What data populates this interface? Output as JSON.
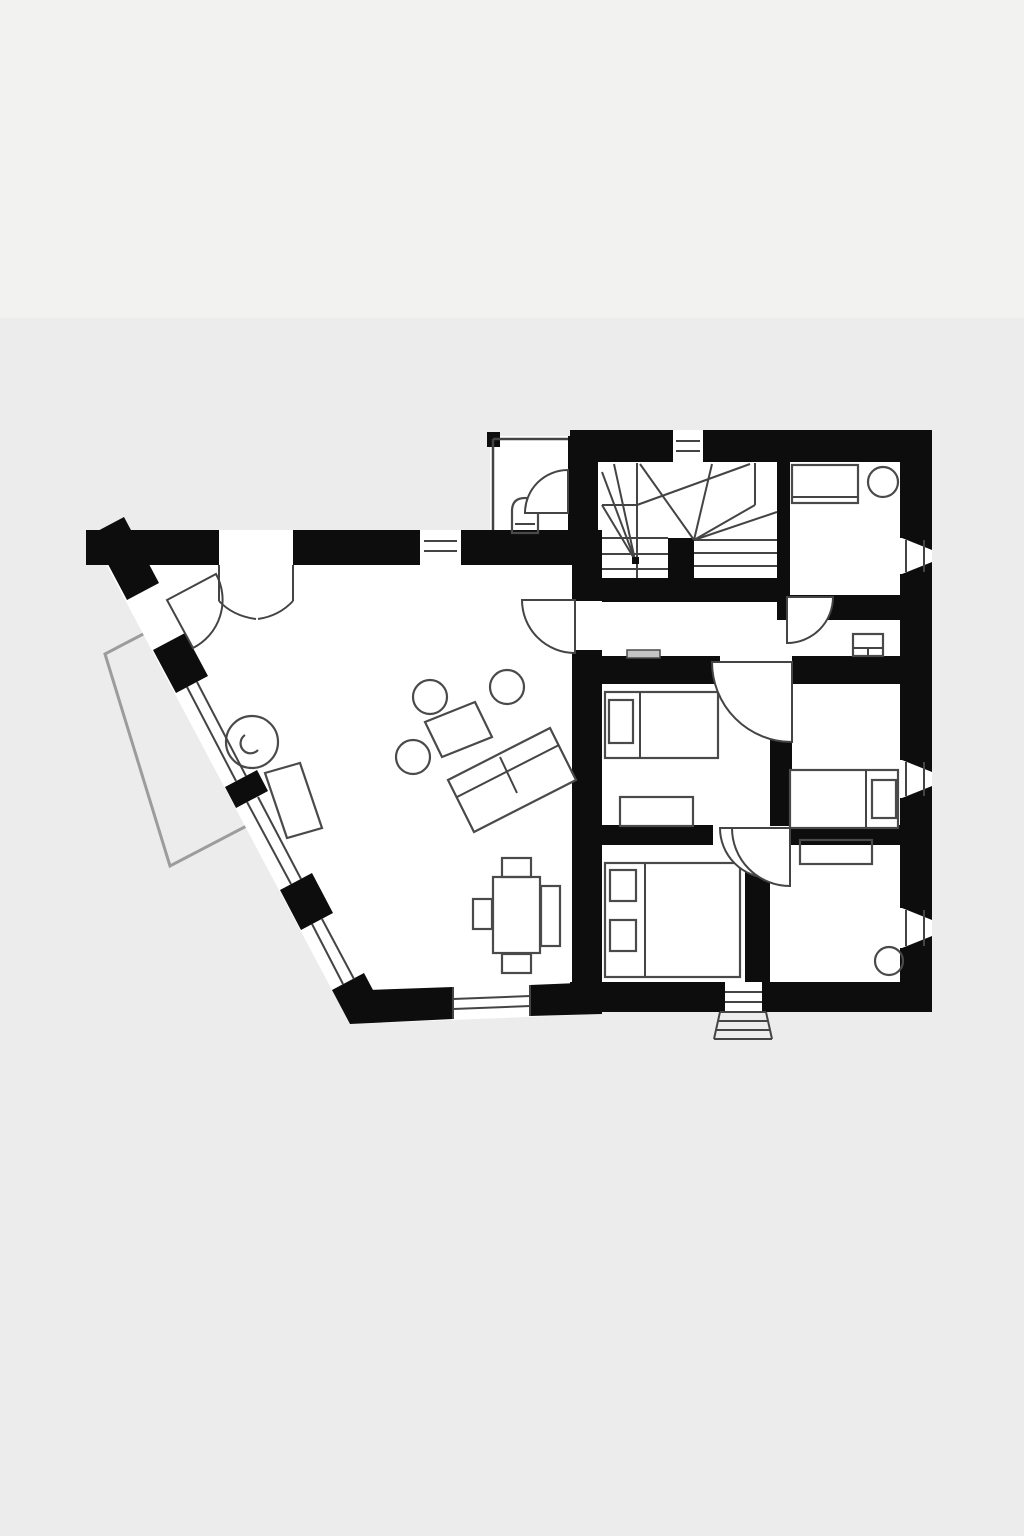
{
  "canvas": {
    "width": 1024,
    "height": 1536
  },
  "colors": {
    "background": "#ececec",
    "background_top": "#f2f2f1",
    "wall": "#0d0d0d",
    "line": "#444444",
    "floor": "#ffffff",
    "furniture": "#4a4a4a",
    "terrace": "#9c9c9c"
  },
  "plan": {
    "type": "apartment-floor-plan",
    "style": "black-and-white architectural drawing, no text labels",
    "rooms": [
      {
        "name": "living-room",
        "shape": "trapezoid with angled west wall"
      },
      {
        "name": "wc-vestibule",
        "feature": "toilet"
      },
      {
        "name": "stair-hall",
        "feature": "winder-staircase with newel post"
      },
      {
        "name": "top-right-room",
        "features": [
          "counter",
          "round-table"
        ]
      },
      {
        "name": "hallway",
        "features": [
          "door-arcs",
          "radiators"
        ]
      },
      {
        "name": "bedroom-middle-left",
        "features": [
          "single-bed",
          "desk"
        ]
      },
      {
        "name": "bedroom-middle-right",
        "features": [
          "single-bed"
        ]
      },
      {
        "name": "bedroom-bottom-left",
        "features": [
          "double-bed"
        ]
      },
      {
        "name": "room-bottom-right",
        "features": [
          "desk",
          "round-stool"
        ]
      }
    ],
    "exterior": [
      {
        "name": "terrace",
        "position": "west, outside angled wall"
      },
      {
        "name": "entry-steps",
        "position": "bottom center"
      }
    ],
    "furniture": [
      "sofa",
      "coffee-table",
      "round-stools",
      "wood-stove",
      "bench",
      "dining-table",
      "dining-chairs",
      "beds-with-pillows",
      "desks",
      "toilet",
      "radiators"
    ],
    "windows": {
      "right-wall": 3,
      "bottom-wall": 2,
      "angled-west-wall": 3,
      "top-wall": 2,
      "type": "splayed openings with double glazing lines"
    },
    "doors": {
      "interior-swing-doors": 8,
      "entrance-double-door": 1
    }
  }
}
